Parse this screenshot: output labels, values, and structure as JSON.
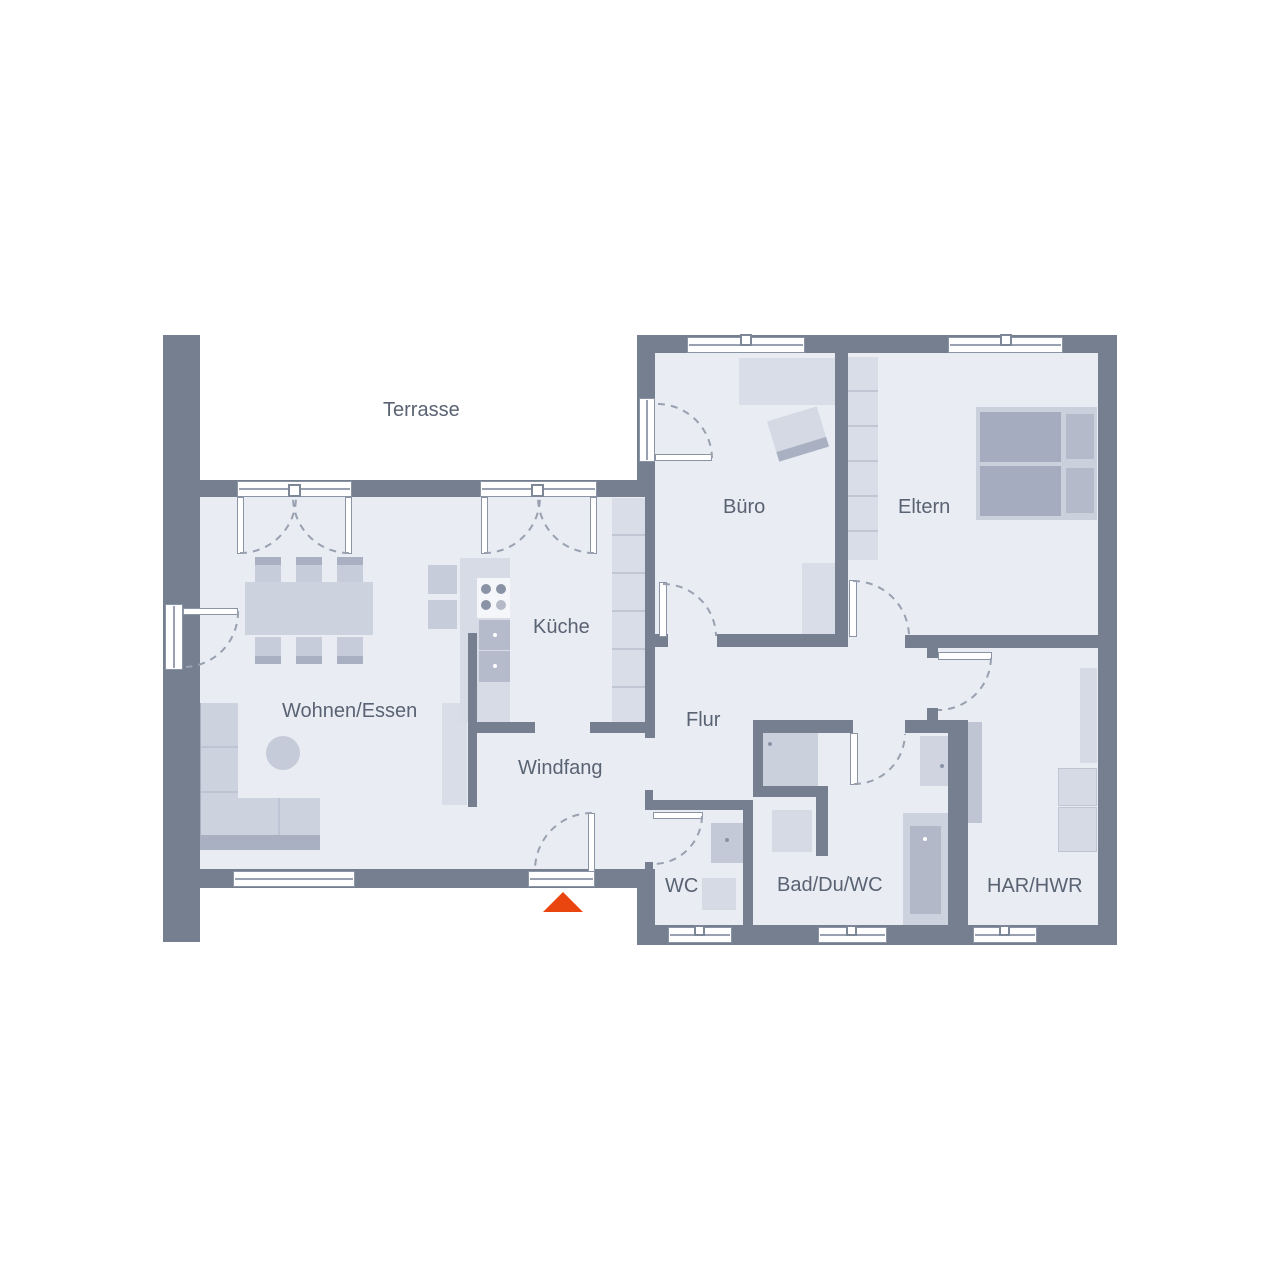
{
  "colors": {
    "wall": "#757F8F",
    "floor": "#E9ECF2",
    "outside": "#FFFFFF",
    "furniture_light": "#D9DDE7",
    "furniture_mid": "#C7CCDA",
    "furniture_dark": "#A9B0C1",
    "bed_mattress": "#A5ACBF",
    "appliance_white": "#F4F6F9",
    "window_frame": "#8B94A4",
    "door_arc": "#99A1B1",
    "label_text": "#5A6373",
    "entrance_arrow": "#E8450F"
  },
  "rooms": {
    "terrasse": {
      "label": "Terrasse"
    },
    "wohnen_essen": {
      "label": "Wohnen/Essen"
    },
    "kueche": {
      "label": "Küche"
    },
    "windfang": {
      "label": "Windfang"
    },
    "flur": {
      "label": "Flur"
    },
    "buero": {
      "label": "Büro"
    },
    "eltern": {
      "label": "Eltern"
    },
    "wc": {
      "label": "WC"
    },
    "bad_du_wc": {
      "label": "Bad/Du/WC"
    },
    "har_hwr": {
      "label": "HAR/HWR"
    }
  },
  "icons": {
    "entrance_arrow_icon": "triangle-up"
  }
}
